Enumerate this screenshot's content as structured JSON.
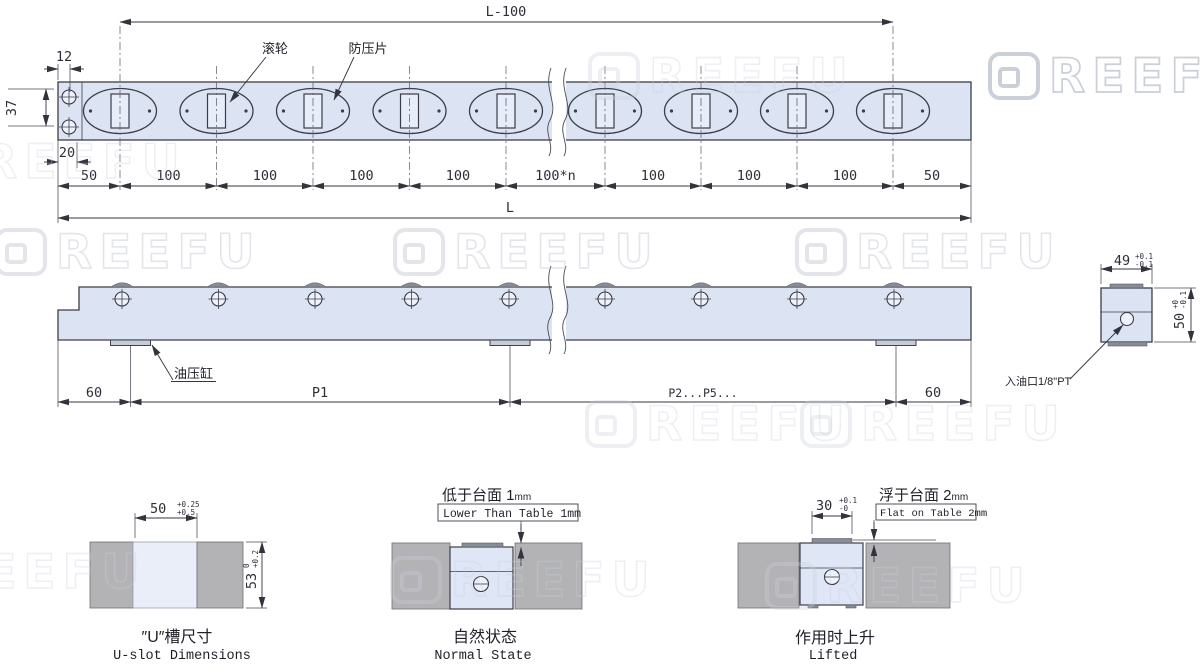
{
  "watermark": {
    "brand_letter": "G",
    "brand_rest": "REEFU"
  },
  "top_view": {
    "roller_label": "滚轮",
    "plate_label": "防压片",
    "dim_L100": "L-100",
    "dim_12": "12",
    "dim_37": "37",
    "dim_20": "20",
    "dim_row": [
      "50",
      "100",
      "100",
      "100",
      "100",
      "100*n",
      "100",
      "100",
      "100",
      "50"
    ],
    "dim_L": "L"
  },
  "side_view": {
    "cylinder_label": "油压缸",
    "dim_60_left": "60",
    "dim_P1": "P1",
    "dim_P2P5": "P2...P5...",
    "dim_60_right": "60"
  },
  "section_view": {
    "oil_port_label": "入油口1/8\"PT",
    "dim_width": "49",
    "dim_width_tol_up": "+0.1",
    "dim_width_tol_dn": "-0.1",
    "dim_height": "50",
    "dim_height_tol_up": "+0",
    "dim_height_tol_dn": "-0.1"
  },
  "detail_uslot": {
    "dim_width": "50",
    "tol_up": "+0.25",
    "tol_dn": "+0.5",
    "dim_depth": "53",
    "depth_tol_up": "0",
    "depth_tol_dn": "+0.2",
    "title_cn": "″U″槽尺寸",
    "title_en": "U-slot Dimensions"
  },
  "detail_normal": {
    "note_cn": "低于台面 1",
    "note_cn_unit": "mm",
    "note_en": "Lower Than Table 1mm",
    "title_cn": "自然状态",
    "title_en": "Normal State"
  },
  "detail_lifted": {
    "dim_width": "30",
    "tol_up": "+0.1",
    "tol_dn": "-0",
    "note_cn": "浮于台面 2",
    "note_cn_unit": "mm",
    "note_en": "Flat on Table 2mm",
    "title_cn": "作用时上升",
    "title_en": "Lifted"
  }
}
